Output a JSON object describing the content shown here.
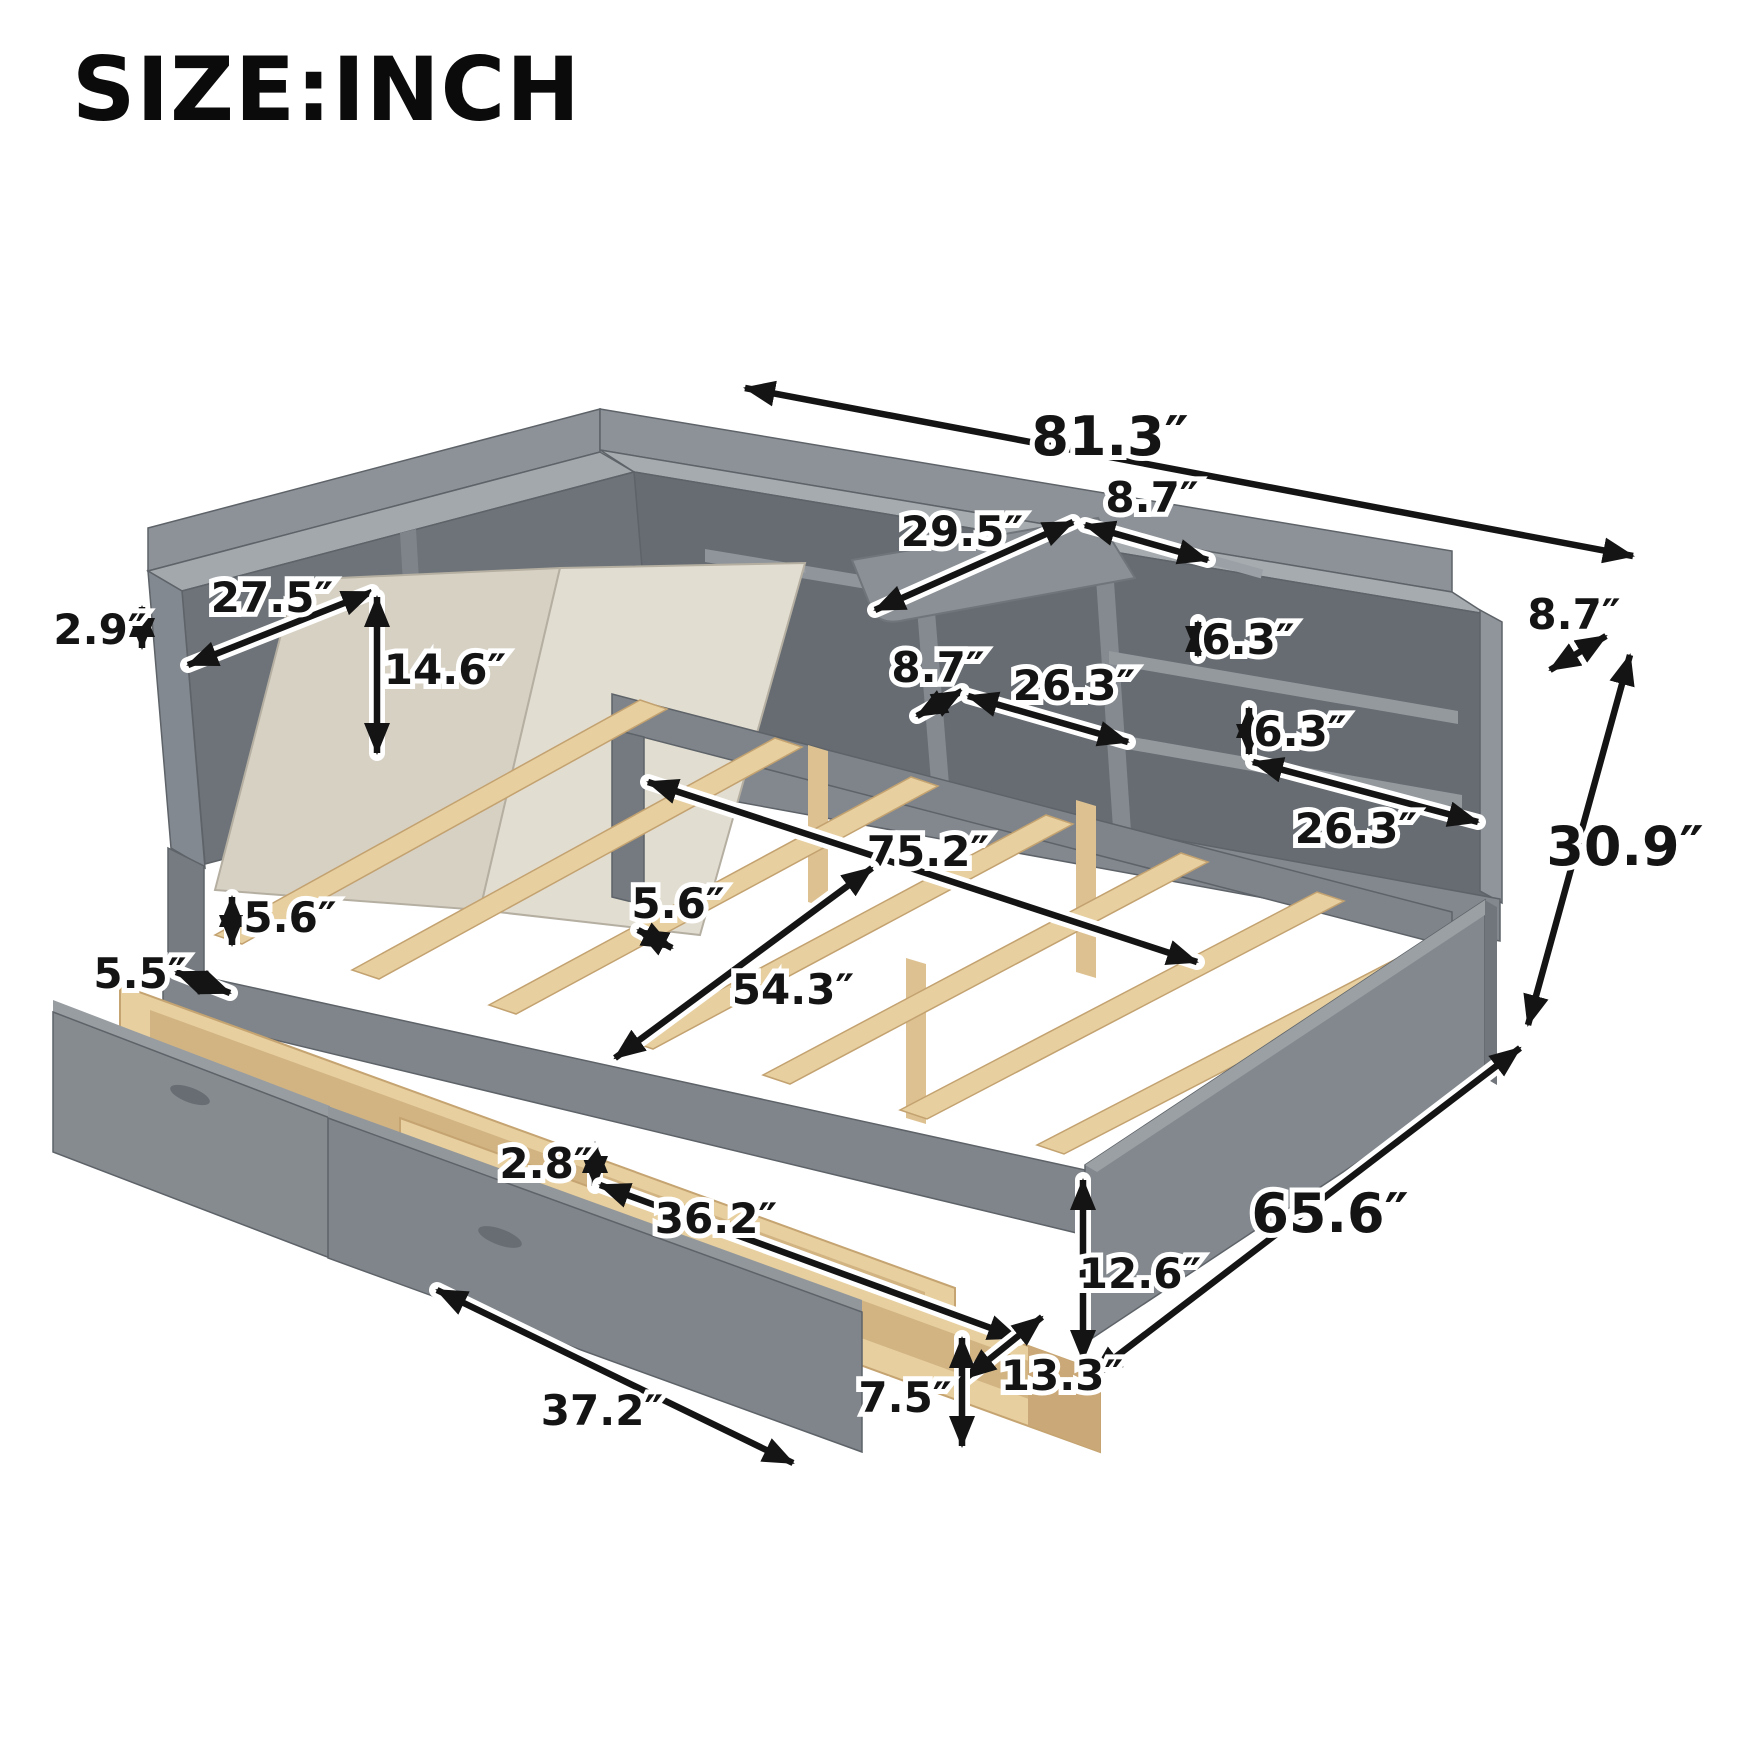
{
  "title": "SIZE:INCH",
  "palette": {
    "background": "#ffffff",
    "panel_top": "#a6abb0",
    "panel": "#868b90",
    "panel_dark": "#666c72",
    "panel_deep": "#565c62",
    "wood": "#e7cf9f",
    "wood_dark": "#d2b482",
    "cushion": "#dcd6c9",
    "arrow": "#141414"
  },
  "diagram": {
    "subject": "daybed with L-shaped bookcase storage, swivel tray, slat platform and two pull-out drawers",
    "dimensions": {
      "overall_length": "81.3″",
      "headboard_top_depth": "8.7″",
      "tray_shelf_length": "29.5″",
      "side_bookcase_width": "27.5″",
      "back_lip_height": "2.9″",
      "side_opening_height": "14.6″",
      "right_end_depth": "8.7″",
      "overall_height": "30.9″",
      "upper_cubby_height": "6.3″",
      "lower_cubby_height": "6.3″",
      "middle_opening_depth": "8.7″",
      "middle_opening_width": "26.3″",
      "right_opening_width": "26.3″",
      "slat_area_length": "75.2″",
      "slat_gap": "5.6″",
      "headboard_clearance": "5.6″",
      "side_rail_width": "5.5″",
      "bed_inner_width": "54.3″",
      "drawer_rim_height": "2.8″",
      "drawer_inner_length": "36.2″",
      "footboard_height": "12.6″",
      "overall_width": "65.6″",
      "drawer_depth": "13.3″",
      "drawer_height": "7.5″",
      "drawer_front_length": "37.2″"
    }
  }
}
